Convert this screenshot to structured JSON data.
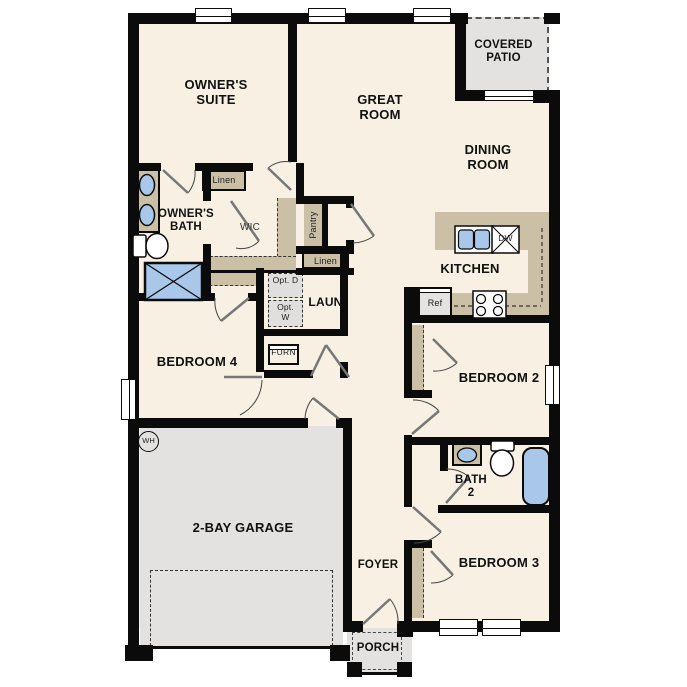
{
  "rooms": {
    "owners_suite": "OWNER'S SUITE",
    "great_room": "GREAT ROOM",
    "covered_patio": "COVERED PATIO",
    "dining_room": "DINING ROOM",
    "owners_bath": "OWNER'S BATH",
    "wic": "WIC",
    "kitchen": "KITCHEN",
    "laundry": "LAUN",
    "bedroom4": "BEDROOM 4",
    "bedroom2": "BEDROOM 2",
    "bath2": "BATH 2",
    "bedroom3": "BEDROOM 3",
    "garage": "2-BAY GARAGE",
    "foyer": "FOYER",
    "porch": "PORCH"
  },
  "closets": {
    "linen_wic": "Linen",
    "pantry": "Pantry",
    "linen_hall": "Linen"
  },
  "appliances": {
    "opt_dryer": "Opt. D",
    "opt_washer": "Opt. W",
    "furnace": "FURN",
    "refrigerator": "Ref",
    "dishwasher": "DW",
    "water_heater": "WH"
  },
  "colors": {
    "floor": "#f8f0e3",
    "casework": "#cbbfa6",
    "exterior_surface": "#e3e2e0",
    "plumbing_fixture": "#a9c8e9",
    "wall": "#0b0b0b"
  }
}
